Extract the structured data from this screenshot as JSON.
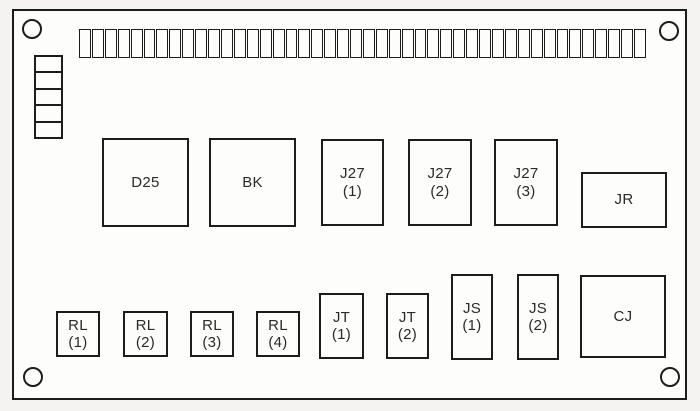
{
  "colors": {
    "line": "#1c1c1c",
    "board_background": "#fdfdfc",
    "page_background": "#f4f3f1",
    "text": "#2a2a2a"
  },
  "board": {
    "mounting_holes": 4,
    "terminal_strip": {
      "segments": 44
    },
    "side_stack": {
      "cells": 5
    }
  },
  "components": [
    {
      "id": "d25",
      "label": "D25",
      "sub": ""
    },
    {
      "id": "bk",
      "label": "BK",
      "sub": ""
    },
    {
      "id": "j27-1",
      "label": "J27",
      "sub": "(1)"
    },
    {
      "id": "j27-2",
      "label": "J27",
      "sub": "(2)"
    },
    {
      "id": "j27-3",
      "label": "J27",
      "sub": "(3)"
    },
    {
      "id": "jr",
      "label": "JR",
      "sub": ""
    },
    {
      "id": "rl-1",
      "label": "RL",
      "sub": "(1)"
    },
    {
      "id": "rl-2",
      "label": "RL",
      "sub": "(2)"
    },
    {
      "id": "rl-3",
      "label": "RL",
      "sub": "(3)"
    },
    {
      "id": "rl-4",
      "label": "RL",
      "sub": "(4)"
    },
    {
      "id": "jt-1",
      "label": "JT",
      "sub": "(1)"
    },
    {
      "id": "jt-2",
      "label": "JT",
      "sub": "(2)"
    },
    {
      "id": "js-1",
      "label": "JS",
      "sub": "(1)"
    },
    {
      "id": "js-2",
      "label": "JS",
      "sub": "(2)"
    },
    {
      "id": "cj",
      "label": "CJ",
      "sub": ""
    }
  ]
}
